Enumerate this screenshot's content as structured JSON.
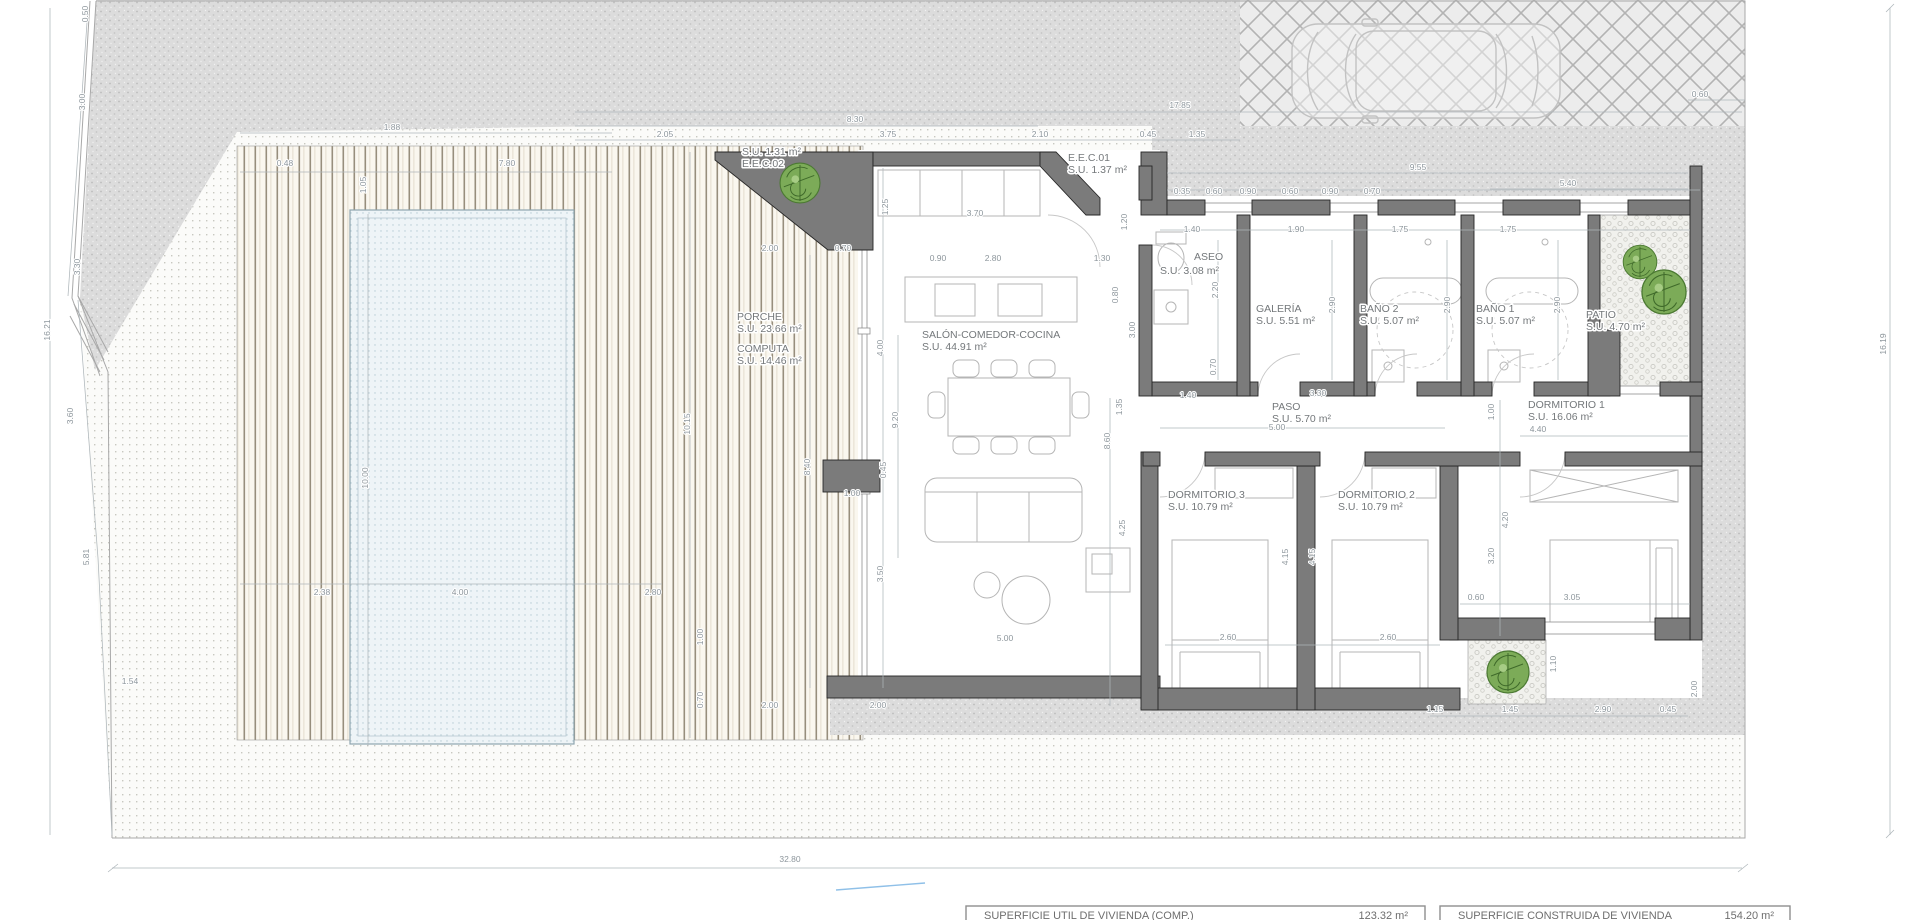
{
  "plan": {
    "colors": {
      "wall": "#7b7b7b",
      "foliage": "#7cab58",
      "pool_tint": "#eef4f7",
      "dim_text": "#8d969c"
    },
    "room_labels": [
      {
        "x": 737,
        "y": 320,
        "lines": [
          "PORCHE",
          "S.U. 23.66 m²"
        ]
      },
      {
        "x": 737,
        "y": 352,
        "lines": [
          "COMPUTA",
          "S.U. 14.46 m²"
        ]
      },
      {
        "x": 922,
        "y": 338,
        "lines": [
          "SALÓN-COMEDOR-COCINA",
          "S.U. 44.91 m²"
        ]
      },
      {
        "x": 1194,
        "y": 260,
        "lines": [
          "ASEO"
        ]
      },
      {
        "x": 1160,
        "y": 274,
        "lines": [
          "S.U. 3.08 m²"
        ]
      },
      {
        "x": 1256,
        "y": 312,
        "lines": [
          "GALERÍA",
          "S.U. 5.51 m²"
        ]
      },
      {
        "x": 1360,
        "y": 312,
        "lines": [
          "BAÑO 2",
          "S.U. 5.07 m²"
        ]
      },
      {
        "x": 1476,
        "y": 312,
        "lines": [
          "BAÑO 1",
          "S.U. 5.07 m²"
        ]
      },
      {
        "x": 1586,
        "y": 318,
        "lines": [
          "PATIO",
          "S.U. 4.70 m²"
        ]
      },
      {
        "x": 1272,
        "y": 410,
        "lines": [
          "PASO",
          "S.U. 5.70 m²"
        ]
      },
      {
        "x": 1528,
        "y": 408,
        "lines": [
          "DORMITORIO 1",
          "S.U. 16.06 m²"
        ]
      },
      {
        "x": 1168,
        "y": 498,
        "lines": [
          "DORMITORIO 3",
          "S.U. 10.79 m²"
        ]
      },
      {
        "x": 1338,
        "y": 498,
        "lines": [
          "DORMITORIO 2",
          "S.U. 10.79 m²"
        ]
      },
      {
        "x": 742,
        "y": 155,
        "lines": [
          "S.U. 1.31 m²",
          "E.E.C.02"
        ]
      },
      {
        "x": 1068,
        "y": 161,
        "lines": [
          "E.E.C.01",
          "S.U. 1.37 m²"
        ]
      }
    ],
    "dimensions": [
      {
        "t": "0.50",
        "x": 88,
        "y": 14,
        "r": 1
      },
      {
        "t": "3.00",
        "x": 85,
        "y": 102,
        "r": 1
      },
      {
        "t": "3.30",
        "x": 80,
        "y": 267,
        "r": 1
      },
      {
        "t": "16.21",
        "x": 50,
        "y": 330,
        "r": 1
      },
      {
        "t": "3.60",
        "x": 73,
        "y": 416,
        "r": 1
      },
      {
        "t": "5.81",
        "x": 89,
        "y": 557,
        "r": 1
      },
      {
        "t": "1.54",
        "x": 130,
        "y": 684
      },
      {
        "t": "32.80",
        "x": 790,
        "y": 862
      },
      {
        "t": "16.19",
        "x": 1886,
        "y": 344,
        "r": 1
      },
      {
        "t": "17.85",
        "x": 1180,
        "y": 108
      },
      {
        "t": "8.30",
        "x": 855,
        "y": 122
      },
      {
        "t": "2.05",
        "x": 665,
        "y": 137
      },
      {
        "t": "3.75",
        "x": 888,
        "y": 137
      },
      {
        "t": "2.10",
        "x": 1040,
        "y": 137
      },
      {
        "t": "0.45",
        "x": 1148,
        "y": 137
      },
      {
        "t": "1.35",
        "x": 1197,
        "y": 137
      },
      {
        "t": "9.55",
        "x": 1418,
        "y": 170
      },
      {
        "t": "5.40",
        "x": 1568,
        "y": 186
      },
      {
        "t": "0.35",
        "x": 1182,
        "y": 194
      },
      {
        "t": "0.60",
        "x": 1214,
        "y": 194
      },
      {
        "t": "0.90",
        "x": 1248,
        "y": 194
      },
      {
        "t": "0.60",
        "x": 1290,
        "y": 194
      },
      {
        "t": "0.90",
        "x": 1330,
        "y": 194
      },
      {
        "t": "0.70",
        "x": 1372,
        "y": 194
      },
      {
        "t": "0.60",
        "x": 1700,
        "y": 97
      },
      {
        "t": "1.88",
        "x": 392,
        "y": 130
      },
      {
        "t": "0.48",
        "x": 285,
        "y": 166
      },
      {
        "t": "7.80",
        "x": 507,
        "y": 166
      },
      {
        "t": "1.05",
        "x": 366,
        "y": 185,
        "r": 1
      },
      {
        "t": "10.00",
        "x": 368,
        "y": 478,
        "r": 1
      },
      {
        "t": "2.38",
        "x": 322,
        "y": 595
      },
      {
        "t": "4.00",
        "x": 460,
        "y": 595
      },
      {
        "t": "2.80",
        "x": 653,
        "y": 595
      },
      {
        "t": "10.15",
        "x": 690,
        "y": 424,
        "r": 1
      },
      {
        "t": "8.40",
        "x": 810,
        "y": 467,
        "r": 1
      },
      {
        "t": "1.00",
        "x": 703,
        "y": 637,
        "r": 1
      },
      {
        "t": "0.70",
        "x": 703,
        "y": 700,
        "r": 1
      },
      {
        "t": "2.00",
        "x": 770,
        "y": 251
      },
      {
        "t": "0.70",
        "x": 843,
        "y": 251
      },
      {
        "t": "1.00",
        "x": 852,
        "y": 496
      },
      {
        "t": "0.45",
        "x": 886,
        "y": 470,
        "r": 1
      },
      {
        "t": "3.70",
        "x": 975,
        "y": 216
      },
      {
        "t": "1.25",
        "x": 888,
        "y": 207,
        "r": 1
      },
      {
        "t": "0.90",
        "x": 938,
        "y": 261
      },
      {
        "t": "2.80",
        "x": 993,
        "y": 261
      },
      {
        "t": "1.30",
        "x": 1102,
        "y": 261
      },
      {
        "t": "1.20",
        "x": 1127,
        "y": 222,
        "r": 1
      },
      {
        "t": "0.80",
        "x": 1118,
        "y": 295,
        "r": 1
      },
      {
        "t": "3.00",
        "x": 1135,
        "y": 330,
        "r": 1
      },
      {
        "t": "4.00",
        "x": 883,
        "y": 348,
        "r": 1
      },
      {
        "t": "9.20",
        "x": 898,
        "y": 420,
        "r": 1
      },
      {
        "t": "3.50",
        "x": 883,
        "y": 574,
        "r": 1
      },
      {
        "t": "5.00",
        "x": 1005,
        "y": 641
      },
      {
        "t": "2.00",
        "x": 770,
        "y": 708
      },
      {
        "t": "2.00",
        "x": 878,
        "y": 708
      },
      {
        "t": "1.40",
        "x": 1192,
        "y": 232
      },
      {
        "t": "1.90",
        "x": 1296,
        "y": 232
      },
      {
        "t": "1.75",
        "x": 1400,
        "y": 232
      },
      {
        "t": "1.75",
        "x": 1508,
        "y": 232
      },
      {
        "t": "2.20",
        "x": 1218,
        "y": 290,
        "r": 1
      },
      {
        "t": "2.90",
        "x": 1335,
        "y": 305,
        "r": 1
      },
      {
        "t": "2.90",
        "x": 1450,
        "y": 305,
        "r": 1
      },
      {
        "t": "2.90",
        "x": 1560,
        "y": 305,
        "r": 1
      },
      {
        "t": "0.70",
        "x": 1216,
        "y": 367,
        "r": 1
      },
      {
        "t": "1.40",
        "x": 1188,
        "y": 398
      },
      {
        "t": "3.30",
        "x": 1318,
        "y": 396
      },
      {
        "t": "5.00",
        "x": 1277,
        "y": 430
      },
      {
        "t": "1.00",
        "x": 1494,
        "y": 412,
        "r": 1
      },
      {
        "t": "4.40",
        "x": 1538,
        "y": 432
      },
      {
        "t": "4.20",
        "x": 1508,
        "y": 520,
        "r": 1
      },
      {
        "t": "3.20",
        "x": 1494,
        "y": 556,
        "r": 1
      },
      {
        "t": "1.35",
        "x": 1122,
        "y": 407,
        "r": 1
      },
      {
        "t": "8.60",
        "x": 1110,
        "y": 441,
        "r": 1
      },
      {
        "t": "4.25",
        "x": 1125,
        "y": 528,
        "r": 1
      },
      {
        "t": "4.15",
        "x": 1288,
        "y": 557,
        "r": 1
      },
      {
        "t": "4.15",
        "x": 1315,
        "y": 557,
        "r": 1
      },
      {
        "t": "2.60",
        "x": 1228,
        "y": 640
      },
      {
        "t": "2.60",
        "x": 1388,
        "y": 640
      },
      {
        "t": "0.60",
        "x": 1476,
        "y": 600
      },
      {
        "t": "3.05",
        "x": 1572,
        "y": 600
      },
      {
        "t": "1.10",
        "x": 1556,
        "y": 664,
        "r": 1
      },
      {
        "t": "1.15",
        "x": 1435,
        "y": 712
      },
      {
        "t": "1.45",
        "x": 1510,
        "y": 712
      },
      {
        "t": "2.90",
        "x": 1603,
        "y": 712
      },
      {
        "t": "0.45",
        "x": 1668,
        "y": 712
      },
      {
        "t": "2.00",
        "x": 1697,
        "y": 689,
        "r": 1
      }
    ],
    "areas_table": {
      "rows": [
        {
          "label": "SUPERFICIE UTIL DE VIVIENDA (COMP.)",
          "value": "123.32 m²"
        },
        {
          "label": "SUPERFICIE CONSTRUIDA DE VIVIENDA",
          "value": "154.20 m²"
        }
      ]
    }
  }
}
